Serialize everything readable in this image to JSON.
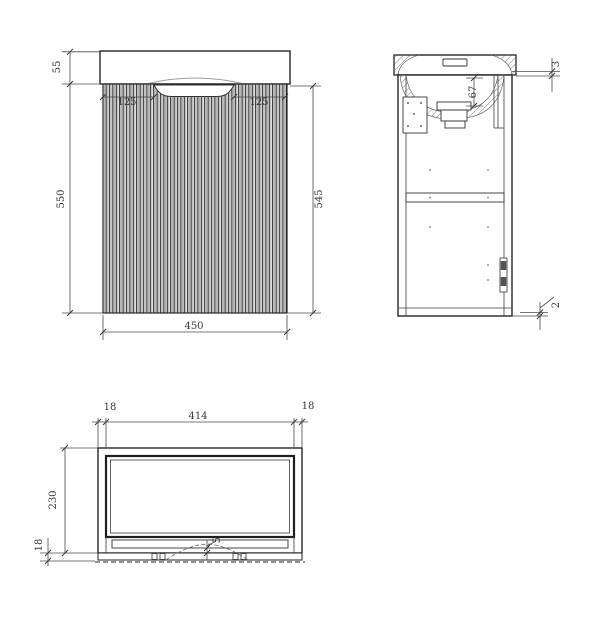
{
  "drawing": {
    "background": "#ffffff",
    "colors": {
      "line": "#262626",
      "inner_line": "#3c3c3c",
      "dim_line": "#4a4a4a",
      "dim_text": "#3a3a3a",
      "flute_dark": "#1e1e1e",
      "flute_light": "#969696"
    },
    "views": {
      "front": {
        "dims": {
          "counter_height": "55",
          "left_flute": "125",
          "right_flute": "125",
          "height_left": "550",
          "height_right": "545",
          "width": "450"
        }
      },
      "side": {
        "dims": {
          "top_overhang": "3",
          "basin_depth": "67",
          "bottom_gap": "2"
        }
      },
      "bottom": {
        "dims": {
          "left_panel": "18",
          "inner_width": "414",
          "right_panel": "18",
          "depth": "230",
          "front_panel": "18",
          "gap": "5"
        }
      }
    }
  }
}
